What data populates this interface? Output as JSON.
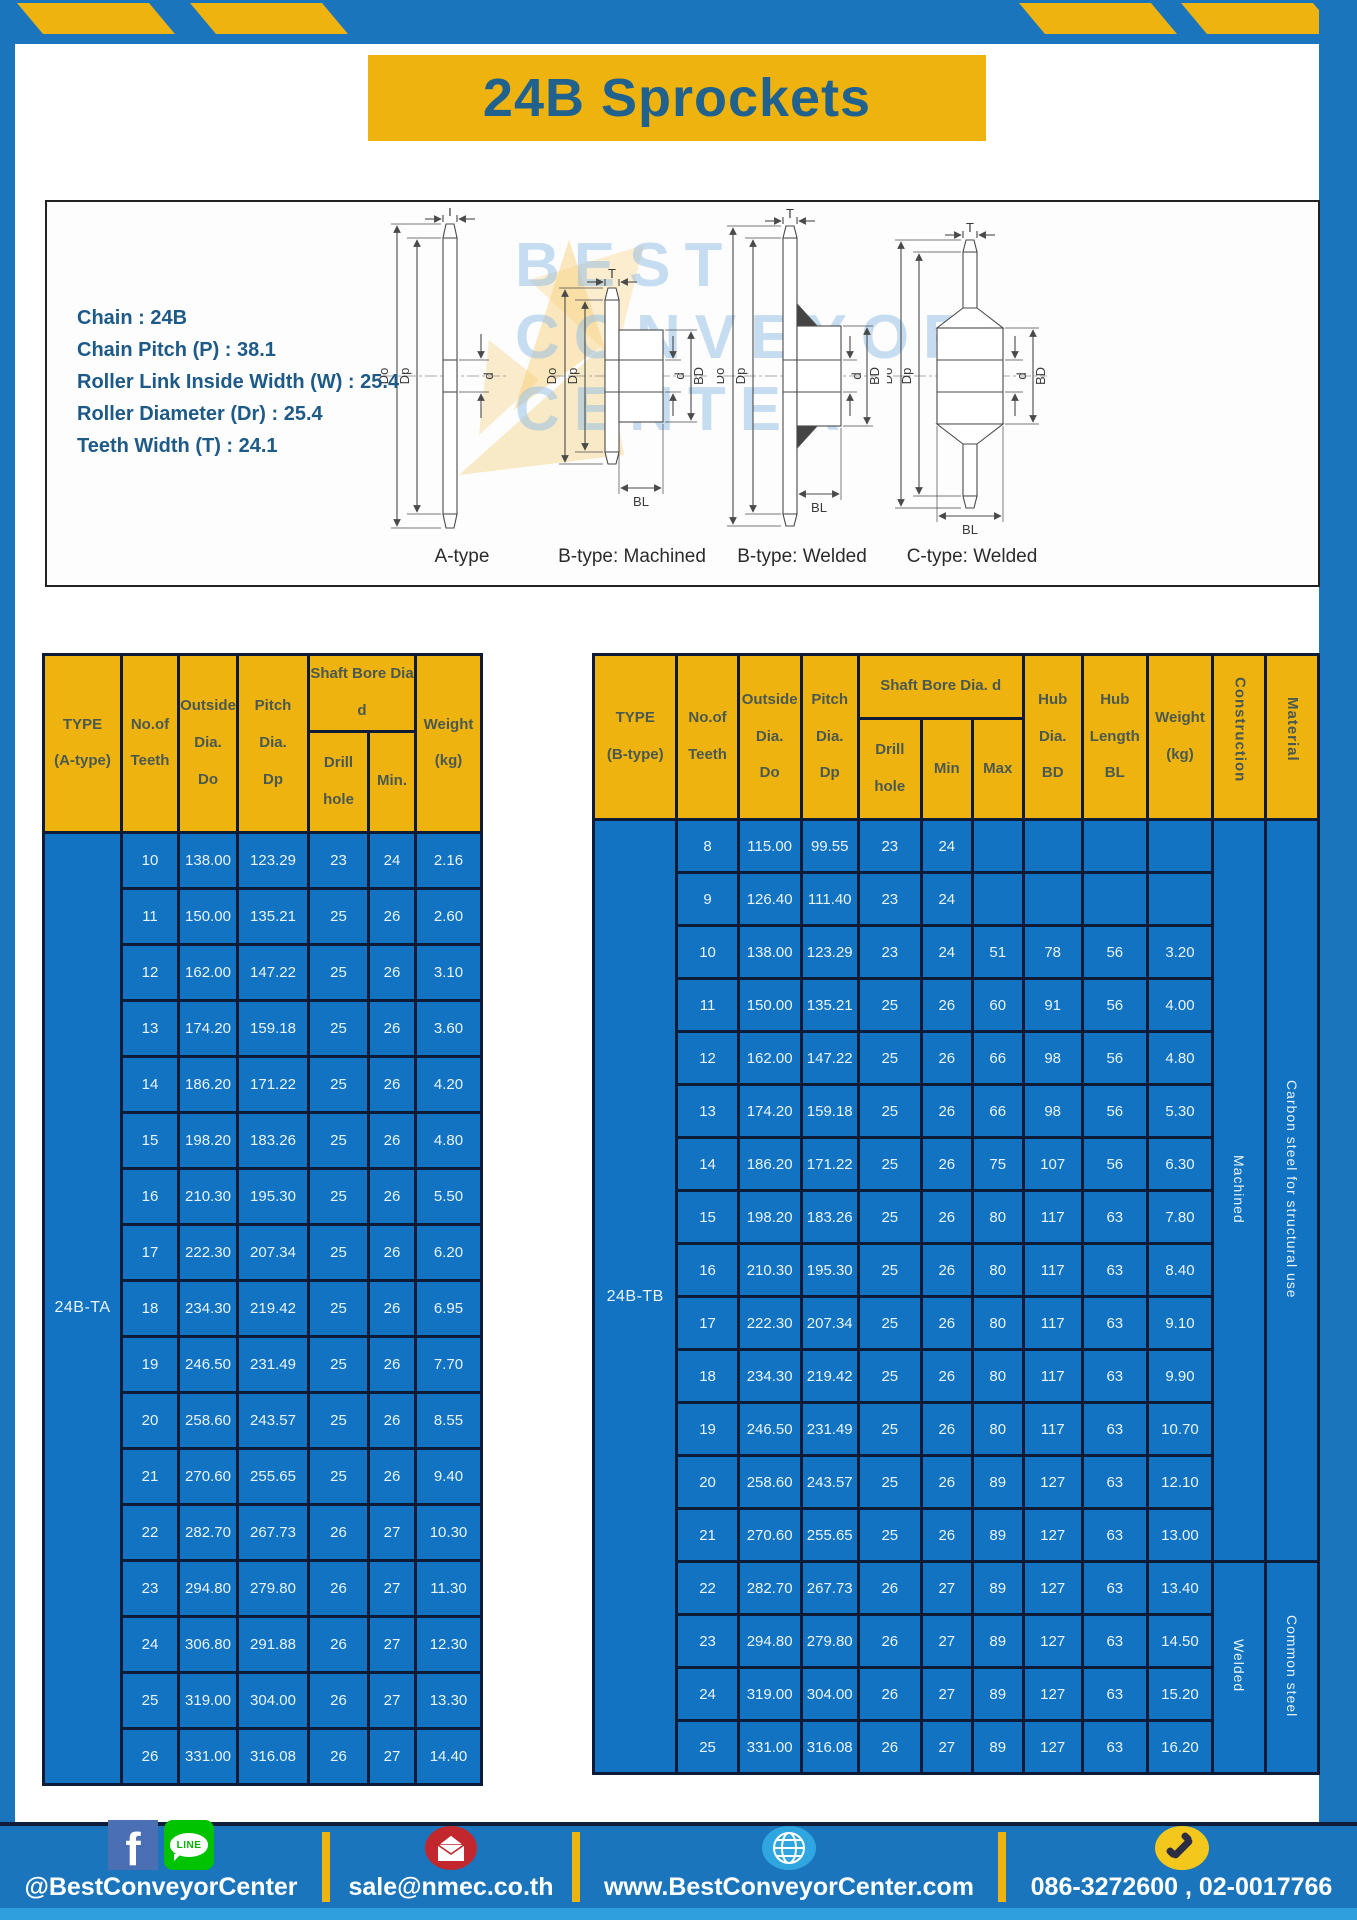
{
  "page": {
    "title": "24B Sprockets"
  },
  "specs": {
    "lines": [
      "Chain : 24B",
      "Chain Pitch (P) : 38.1",
      "Roller Link Inside Width (W) : 25.4",
      "Roller Diameter (Dr) : 25.4",
      "Teeth Width (T) : 24.1"
    ]
  },
  "diagram": {
    "captions": [
      "A-type",
      "B-type: Machined",
      "B-type: Welded",
      "C-type: Welded"
    ],
    "labels": {
      "t": "T",
      "do": "Do",
      "dp": "Dp",
      "d": "d",
      "bd": "BD",
      "bl": "BL"
    },
    "watermark": [
      "BEST",
      "CONVEYOR",
      "CENTER"
    ]
  },
  "table_a": {
    "headers": {
      "type": "TYPE\n(A-type)",
      "teeth": "No.of\nTeeth",
      "outside": "Outside\nDia.\nDo",
      "pitch": "Pitch Dia.\nDp",
      "shaft_bore": "Shaft Bore Dia d",
      "drill": "Drill hole",
      "min": "Min.",
      "weight": "Weight\n(kg)"
    },
    "type_label": "24B-TA",
    "rows": [
      [
        "10",
        "138.00",
        "123.29",
        "23",
        "24",
        "2.16"
      ],
      [
        "11",
        "150.00",
        "135.21",
        "25",
        "26",
        "2.60"
      ],
      [
        "12",
        "162.00",
        "147.22",
        "25",
        "26",
        "3.10"
      ],
      [
        "13",
        "174.20",
        "159.18",
        "25",
        "26",
        "3.60"
      ],
      [
        "14",
        "186.20",
        "171.22",
        "25",
        "26",
        "4.20"
      ],
      [
        "15",
        "198.20",
        "183.26",
        "25",
        "26",
        "4.80"
      ],
      [
        "16",
        "210.30",
        "195.30",
        "25",
        "26",
        "5.50"
      ],
      [
        "17",
        "222.30",
        "207.34",
        "25",
        "26",
        "6.20"
      ],
      [
        "18",
        "234.30",
        "219.42",
        "25",
        "26",
        "6.95"
      ],
      [
        "19",
        "246.50",
        "231.49",
        "25",
        "26",
        "7.70"
      ],
      [
        "20",
        "258.60",
        "243.57",
        "25",
        "26",
        "8.55"
      ],
      [
        "21",
        "270.60",
        "255.65",
        "25",
        "26",
        "9.40"
      ],
      [
        "22",
        "282.70",
        "267.73",
        "26",
        "27",
        "10.30"
      ],
      [
        "23",
        "294.80",
        "279.80",
        "26",
        "27",
        "11.30"
      ],
      [
        "24",
        "306.80",
        "291.88",
        "26",
        "27",
        "12.30"
      ],
      [
        "25",
        "319.00",
        "304.00",
        "26",
        "27",
        "13.30"
      ],
      [
        "26",
        "331.00",
        "316.08",
        "26",
        "27",
        "14.40"
      ]
    ],
    "spans": []
  },
  "table_b": {
    "headers": {
      "type": "TYPE\n(B-type)",
      "teeth": "No.of\nTeeth",
      "outside": "Outside\nDia.\nDo",
      "pitch": "Pitch\nDia.\nDp",
      "shaft_bore": "Shaft Bore Dia. d",
      "drill": "Drill hole",
      "min": "Min",
      "max": "Max",
      "hub_dia": "Hub\nDia.\nBD",
      "hub_len": "Hub\nLength\nBL",
      "weight": "Weight\n(kg)",
      "construction": "Construction",
      "material": "Material"
    },
    "type_label": "24B-TB",
    "rows": [
      [
        "8",
        "115.00",
        "99.55",
        "23",
        "24",
        "",
        "",
        "",
        ""
      ],
      [
        "9",
        "126.40",
        "111.40",
        "23",
        "24",
        "",
        "",
        "",
        ""
      ],
      [
        "10",
        "138.00",
        "123.29",
        "23",
        "24",
        "51",
        "78",
        "56",
        "3.20"
      ],
      [
        "11",
        "150.00",
        "135.21",
        "25",
        "26",
        "60",
        "91",
        "56",
        "4.00"
      ],
      [
        "12",
        "162.00",
        "147.22",
        "25",
        "26",
        "66",
        "98",
        "56",
        "4.80"
      ],
      [
        "13",
        "174.20",
        "159.18",
        "25",
        "26",
        "66",
        "98",
        "56",
        "5.30"
      ],
      [
        "14",
        "186.20",
        "171.22",
        "25",
        "26",
        "75",
        "107",
        "56",
        "6.30"
      ],
      [
        "15",
        "198.20",
        "183.26",
        "25",
        "26",
        "80",
        "117",
        "63",
        "7.80"
      ],
      [
        "16",
        "210.30",
        "195.30",
        "25",
        "26",
        "80",
        "117",
        "63",
        "8.40"
      ],
      [
        "17",
        "222.30",
        "207.34",
        "25",
        "26",
        "80",
        "117",
        "63",
        "9.10"
      ],
      [
        "18",
        "234.30",
        "219.42",
        "25",
        "26",
        "80",
        "117",
        "63",
        "9.90"
      ],
      [
        "19",
        "246.50",
        "231.49",
        "25",
        "26",
        "80",
        "117",
        "63",
        "10.70"
      ],
      [
        "20",
        "258.60",
        "243.57",
        "25",
        "26",
        "89",
        "127",
        "63",
        "12.10"
      ],
      [
        "21",
        "270.60",
        "255.65",
        "25",
        "26",
        "89",
        "127",
        "63",
        "13.00"
      ],
      [
        "22",
        "282.70",
        "267.73",
        "26",
        "27",
        "89",
        "127",
        "63",
        "13.40"
      ],
      [
        "23",
        "294.80",
        "279.80",
        "26",
        "27",
        "89",
        "127",
        "63",
        "14.50"
      ],
      [
        "24",
        "319.00",
        "304.00",
        "26",
        "27",
        "89",
        "127",
        "63",
        "15.20"
      ],
      [
        "25",
        "331.00",
        "316.08",
        "26",
        "27",
        "89",
        "127",
        "63",
        "16.20"
      ]
    ],
    "spans": [
      {
        "start": 0,
        "span": 14,
        "label": "Machined",
        "name": "construction-cell"
      },
      {
        "start": 0,
        "span": 14,
        "label": "Carbon steel for structural use",
        "name": "material-cell"
      },
      {
        "start": 14,
        "span": 4,
        "label": "Welded",
        "name": "construction-cell"
      },
      {
        "start": 14,
        "span": 4,
        "label": "Common steel",
        "name": "material-cell"
      }
    ]
  },
  "footer": {
    "social_handle": "@BestConveyorCenter",
    "email": "sale@nmec.co.th",
    "website": "www.BestConveyorCenter.com",
    "phones": "086-3272600 , 02-0017766",
    "facebook_f": "f",
    "line_label": "LINE"
  },
  "colors": {
    "brand_blue": "#1b75bc",
    "brand_yellow": "#efb310",
    "table_cell_blue": "#1173c1",
    "table_border_navy": "#0d1b36",
    "title_text": "#21618e",
    "footer_strip": "#2fa0dd"
  }
}
